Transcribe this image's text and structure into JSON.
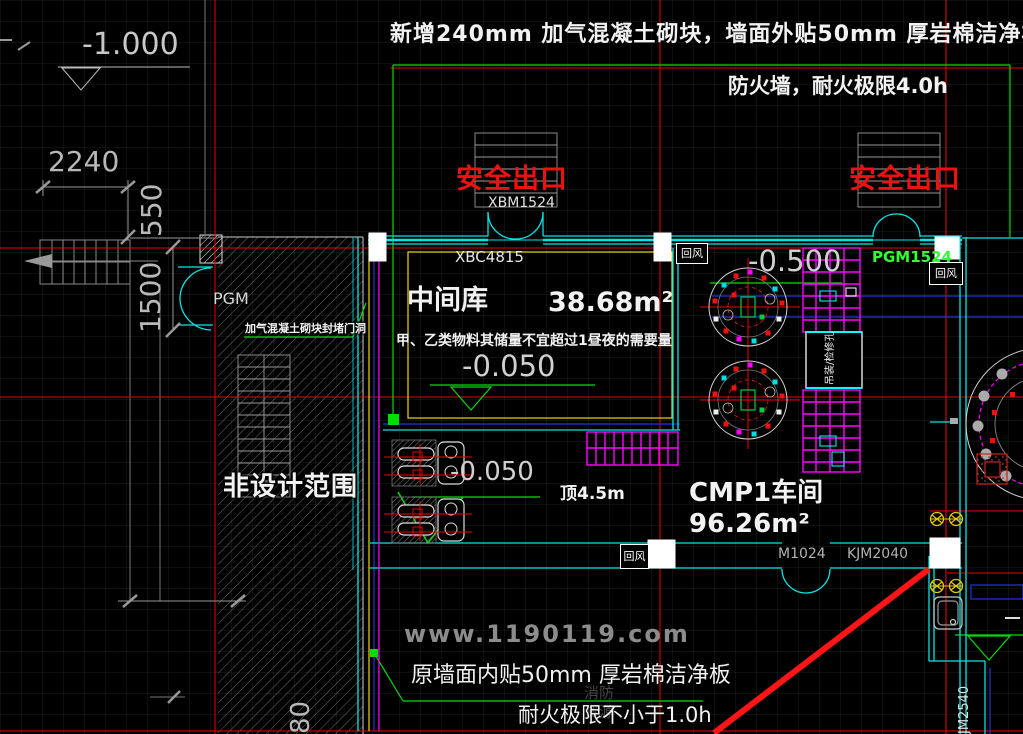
{
  "drawing": {
    "top_notes": {
      "line1": "新增240mm 加气混凝土砌块，墙面外贴50mm 厚岩棉洁净板",
      "line2": "防火墙，耐火极限4.0h"
    },
    "bottom_notes": {
      "line1": "原墙面内贴50mm 厚岩棉洁净板",
      "line2": "耐火极限不小于1.0h"
    },
    "rooms": {
      "middle_store": {
        "name": "中间库",
        "area": "38.68m²",
        "note": "甲、乙类物料其储量不宜超过1昼夜的需要量"
      },
      "cmp_workshop": {
        "name": "CMP1车间",
        "area": "96.26m²",
        "ceiling_height": "顶4.5m"
      },
      "non_design": {
        "name": "非设计范围"
      }
    },
    "exits": {
      "exit1": "安全出口",
      "exit2": "安全出口"
    },
    "doors": {
      "xbm1524": "XBM1524",
      "xbc4815": "XBC4815",
      "pgm1524": "PGM1524",
      "pgm": "PGM",
      "m1024": "M1024",
      "kjm2040": "KJM2040",
      "jm2540": "JM2540"
    },
    "elevations": {
      "entry": "-1.000",
      "store_floor": "-0.050",
      "pump_floor": "-0.050",
      "right_floor": "-0.500"
    },
    "dimensions": {
      "d2240": "2240",
      "d550": "550",
      "d1500": "1500",
      "d80": "80"
    },
    "labels": {
      "return_air": "回风",
      "block_door_note": "加气混凝土砌块封堵门洞",
      "shaft": "吊装/检修孔"
    },
    "watermark": {
      "url": "www.1190119.com",
      "brand": "消防资源"
    }
  },
  "colors": {
    "background": "#000000",
    "wall_cyan": "#00e5e5",
    "axis_red": "#e80000",
    "annotation_green": "#00dd00",
    "equipment_magenta": "#ff00ff",
    "detail_yellow": "#f0d800",
    "line_blue": "#2233dd",
    "text_white": "#f2f2f2",
    "dim_gray": "#b2b2b2",
    "exit_red": "#ee1111",
    "door_green": "#33ff33"
  }
}
